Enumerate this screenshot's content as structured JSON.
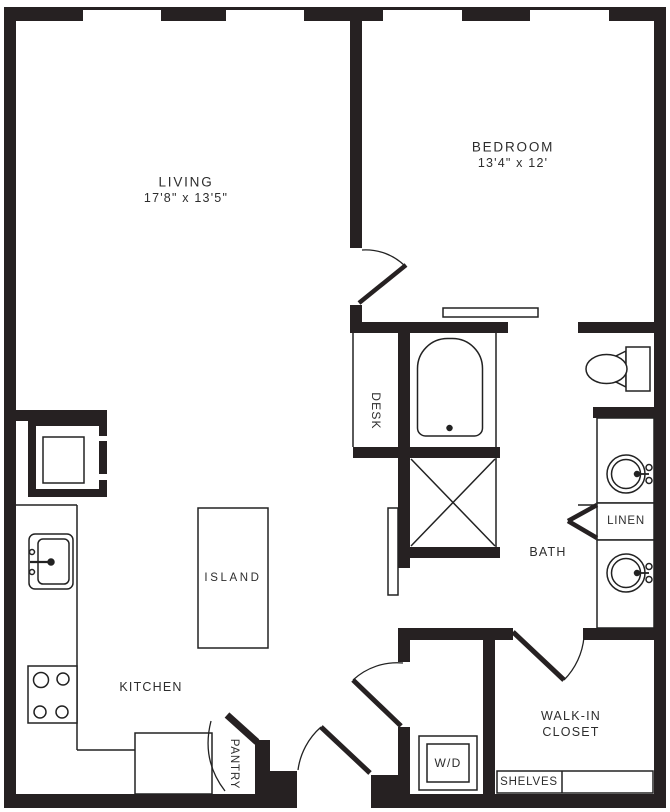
{
  "colors": {
    "wall": "#262122",
    "line": "#222222",
    "background": "#ffffff",
    "text": "#2d2d2d"
  },
  "rooms": {
    "living": {
      "label": "LIVING",
      "dimensions": "17'8\" x 13'5\""
    },
    "bedroom": {
      "label": "BEDROOM",
      "dimensions": "13'4\" x 12'"
    },
    "kitchen": {
      "label": "KITCHEN"
    },
    "island": {
      "label": "ISLAND"
    },
    "desk": {
      "label": "DESK"
    },
    "pantry": {
      "label": "PANTRY"
    },
    "bath": {
      "label": "BATH"
    },
    "linen": {
      "label": "LINEN"
    },
    "walk_in_closet": {
      "label_line_1": "WALK-IN",
      "label_line_2": "CLOSET"
    },
    "washer_dryer": {
      "label": "W/D"
    },
    "shelves": {
      "label": "SHELVES"
    }
  },
  "fixture_icons": [
    "bathtub-icon",
    "shower-icon",
    "toilet-icon",
    "vanity-sink-icon",
    "kitchen-sink-icon",
    "stove-icon",
    "refrigerator-icon",
    "kitchen-island-icon",
    "washer-dryer-icon",
    "shelves-icon",
    "window-icon",
    "door-swing-icon",
    "sliding-door-icon"
  ]
}
